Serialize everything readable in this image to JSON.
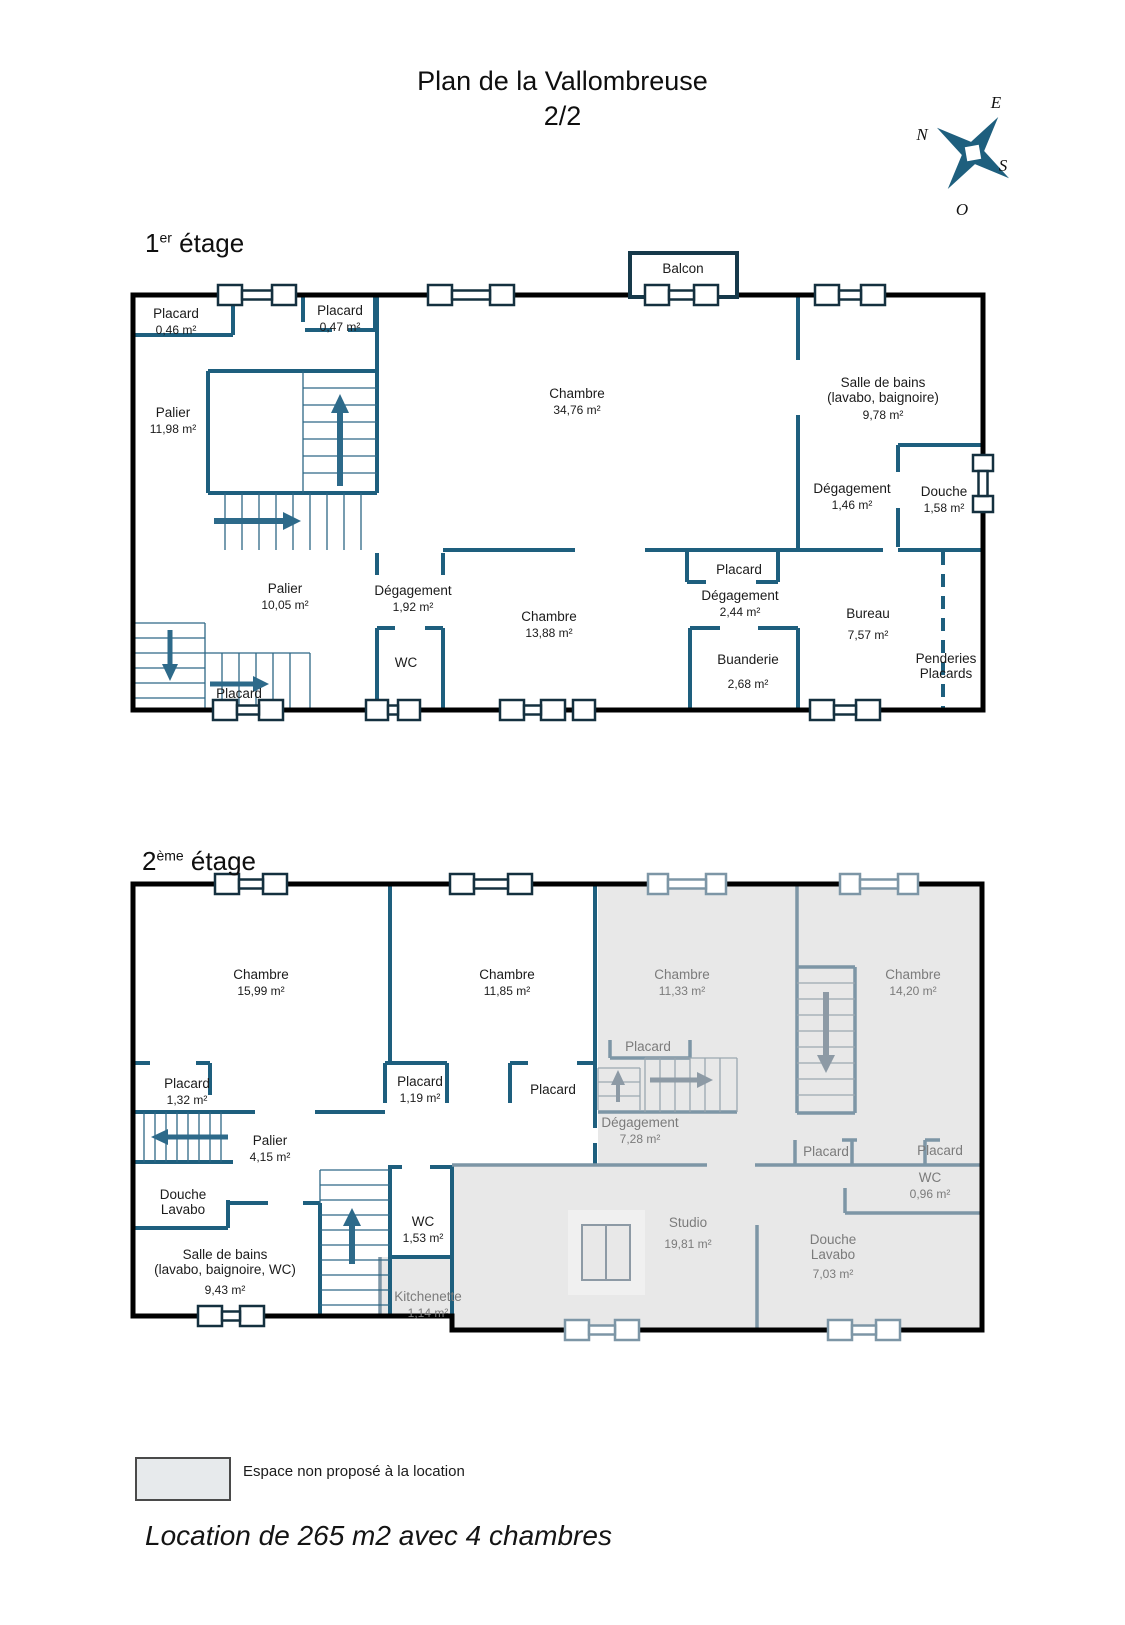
{
  "title": {
    "line1": "Plan de la Vallombreuse",
    "line2": "2/2"
  },
  "compass": {
    "n": "N",
    "e": "E",
    "s": "S",
    "o": "O"
  },
  "colors": {
    "wall_teal": "#1e5f7e",
    "excluded_fill": "#e8e8e8",
    "excluded_wall": "#7d96a6"
  },
  "legend": {
    "text": "Espace non proposé à la location"
  },
  "footer": {
    "text": "Location de 265 m2 avec 4 chambres"
  },
  "floor1": {
    "heading": {
      "base": "1",
      "sup": "er",
      "rest": " étage"
    },
    "rooms": {
      "balcon": {
        "name": "Balcon"
      },
      "placard_a": {
        "name": "Placard",
        "area": "0,46 m²"
      },
      "placard_b": {
        "name": "Placard",
        "area": "0,47 m²"
      },
      "palier_a": {
        "name": "Palier",
        "area": "11,98 m²"
      },
      "chambre_a": {
        "name": "Chambre",
        "area": "34,76 m²"
      },
      "salle_de_bains": {
        "name": "Salle de bains\n(lavabo, baignoire)",
        "area": "9,78 m²"
      },
      "degagement_a": {
        "name": "Dégagement",
        "area": "1,46 m²"
      },
      "douche": {
        "name": "Douche",
        "area": "1,58 m²"
      },
      "palier_b": {
        "name": "Palier",
        "area": "10,05 m²"
      },
      "degagement_b": {
        "name": "Dégagement",
        "area": "1,92 m²"
      },
      "chambre_b": {
        "name": "Chambre",
        "area": "13,88 m²"
      },
      "wc": {
        "name": "WC"
      },
      "placard_c": {
        "name": "Placard"
      },
      "degagement_c": {
        "name": "Dégagement",
        "area": "2,44 m²"
      },
      "buanderie": {
        "name": "Buanderie",
        "area": "2,68 m²"
      },
      "bureau": {
        "name": "Bureau",
        "area": "7,57 m²"
      },
      "penderies": {
        "name": "Penderies\nPlacards"
      },
      "placard_d": {
        "name": "Placard"
      }
    }
  },
  "floor2": {
    "heading": {
      "base": "2",
      "sup": "ème",
      "rest": " étage"
    },
    "rooms": {
      "chambre_a": {
        "name": "Chambre",
        "area": "15,99 m²"
      },
      "chambre_b": {
        "name": "Chambre",
        "area": "11,85 m²"
      },
      "chambre_c": {
        "name": "Chambre",
        "area": "11,33 m²"
      },
      "chambre_d": {
        "name": "Chambre",
        "area": "14,20 m²"
      },
      "placard_a": {
        "name": "Placard",
        "area": "1,32 m²"
      },
      "placard_b": {
        "name": "Placard",
        "area": "1,19 m²"
      },
      "placard_c": {
        "name": "Placard"
      },
      "placard_d": {
        "name": "Placard"
      },
      "degagement": {
        "name": "Dégagement",
        "area": "7,28 m²"
      },
      "placard_e": {
        "name": "Placard"
      },
      "placard_f": {
        "name": "Placard"
      },
      "wc_a": {
        "name": "WC",
        "area": "0,96 m²"
      },
      "palier": {
        "name": "Palier",
        "area": "4,15 m²"
      },
      "douche_lavabo_a": {
        "name": "Douche\nLavabo"
      },
      "salle_de_bains": {
        "name": "Salle de bains\n(lavabo, baignoire, WC)",
        "area": "9,43 m²"
      },
      "wc_b": {
        "name": "WC",
        "area": "1,53 m²"
      },
      "kitchenette": {
        "name": "Kitchenette",
        "area": "1,14 m²"
      },
      "studio": {
        "name": "Studio",
        "area": "19,81 m²"
      },
      "douche_lavabo_b": {
        "name": "Douche\nLavabo",
        "area": "7,03 m²"
      }
    }
  }
}
